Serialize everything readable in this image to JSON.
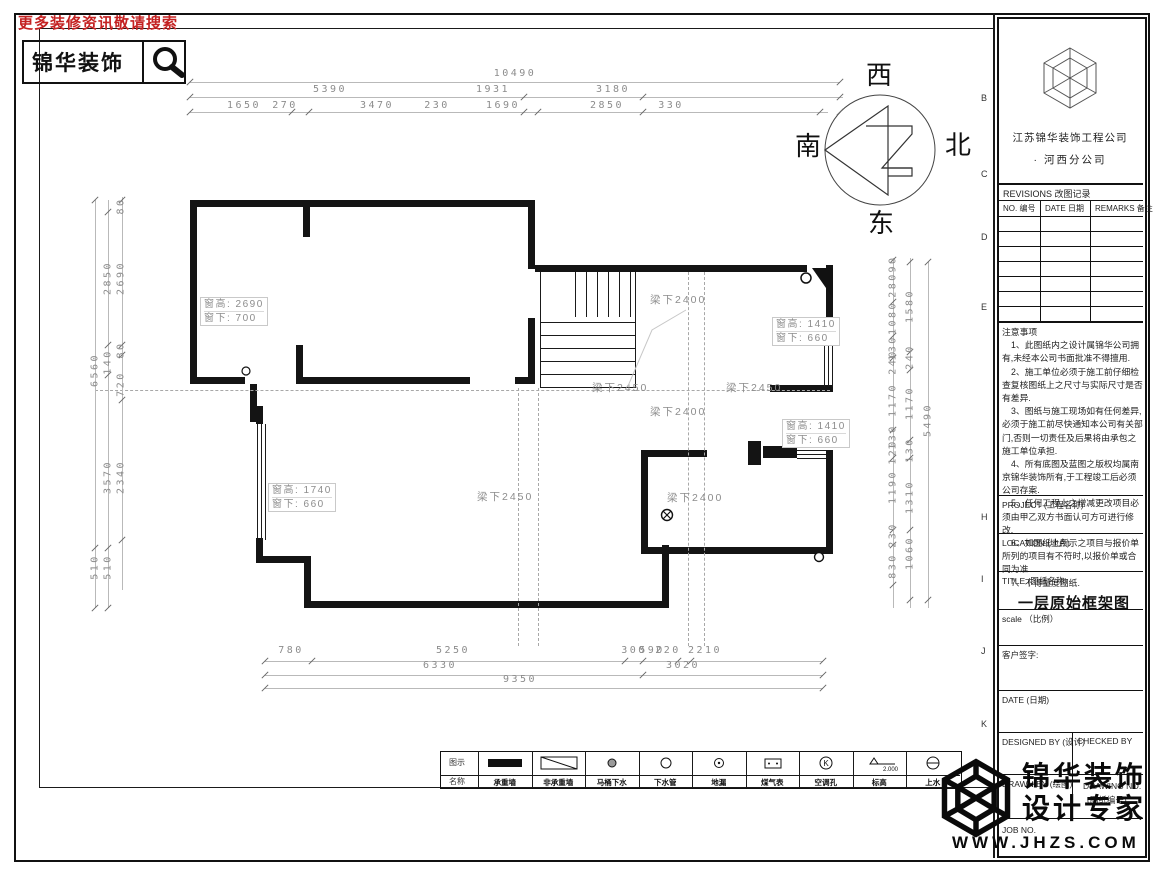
{
  "header": {
    "slogan": "更多装修资讯敬请搜索",
    "brand": "锦华装饰"
  },
  "compass": {
    "west": "西",
    "south": "南",
    "north": "北",
    "east": "东"
  },
  "zone_letters": [
    {
      "t": "B",
      "y": 93
    },
    {
      "t": "C",
      "y": 169
    },
    {
      "t": "D",
      "y": 232
    },
    {
      "t": "E",
      "y": 302
    },
    {
      "t": "H",
      "y": 512
    },
    {
      "t": "I",
      "y": 574
    },
    {
      "t": "J",
      "y": 646
    },
    {
      "t": "K",
      "y": 719
    }
  ],
  "plan": {
    "window_labels": [
      {
        "l1": "窗高: 2690",
        "l2": "窗下: 700",
        "x": 200,
        "y": 297
      },
      {
        "l1": "窗高: 1410",
        "l2": "窗下: 660",
        "x": 772,
        "y": 317
      },
      {
        "l1": "窗高: 1410",
        "l2": "窗下: 660",
        "x": 782,
        "y": 419
      },
      {
        "l1": "窗高: 1740",
        "l2": "窗下: 660",
        "x": 268,
        "y": 483
      }
    ],
    "beam_labels": [
      {
        "t": "梁下2400",
        "x": 650,
        "y": 292
      },
      {
        "t": "梁下2450",
        "x": 592,
        "y": 380
      },
      {
        "t": "梁下2450",
        "x": 726,
        "y": 380
      },
      {
        "t": "梁下2400",
        "x": 650,
        "y": 404
      },
      {
        "t": "梁下2450",
        "x": 477,
        "y": 489
      },
      {
        "t": "梁下2400",
        "x": 667,
        "y": 490
      }
    ]
  },
  "dims": {
    "top": [
      {
        "t": "10490",
        "x": 515,
        "y": 68
      },
      {
        "t": "5390",
        "x": 330,
        "y": 84
      },
      {
        "t": "1931",
        "x": 493,
        "y": 84
      },
      {
        "t": "3180",
        "x": 613,
        "y": 84
      },
      {
        "t": "1650",
        "x": 244,
        "y": 100
      },
      {
        "t": "270",
        "x": 285,
        "y": 100
      },
      {
        "t": "3470",
        "x": 377,
        "y": 100
      },
      {
        "t": "230",
        "x": 437,
        "y": 100
      },
      {
        "t": "1690",
        "x": 503,
        "y": 100
      },
      {
        "t": "2850",
        "x": 607,
        "y": 100
      },
      {
        "t": "330",
        "x": 671,
        "y": 100
      }
    ],
    "bottom": [
      {
        "t": "780",
        "x": 291,
        "y": 645
      },
      {
        "t": "5250",
        "x": 453,
        "y": 645
      },
      {
        "t": "300",
        "x": 634,
        "y": 645
      },
      {
        "t": "590",
        "x": 652,
        "y": 645
      },
      {
        "t": "220",
        "x": 668,
        "y": 645
      },
      {
        "t": "2210",
        "x": 705,
        "y": 645
      },
      {
        "t": "6330",
        "x": 440,
        "y": 660
      },
      {
        "t": "3020",
        "x": 683,
        "y": 660
      },
      {
        "t": "9350",
        "x": 520,
        "y": 674
      }
    ],
    "left": [
      {
        "t": "6560",
        "x": 95,
        "y": 370
      },
      {
        "t": "510",
        "x": 95,
        "y": 567
      },
      {
        "t": "2850",
        "x": 108,
        "y": 278
      },
      {
        "t": "140",
        "x": 108,
        "y": 362
      },
      {
        "t": "3570",
        "x": 108,
        "y": 477
      },
      {
        "t": "510",
        "x": 108,
        "y": 567
      },
      {
        "t": "80",
        "x": 121,
        "y": 206
      },
      {
        "t": "2690",
        "x": 121,
        "y": 278
      },
      {
        "t": "80",
        "x": 121,
        "y": 350
      },
      {
        "t": "720",
        "x": 121,
        "y": 384
      },
      {
        "t": "2340",
        "x": 121,
        "y": 477
      }
    ],
    "right": [
      {
        "t": "90",
        "x": 893,
        "y": 264
      },
      {
        "t": "280",
        "x": 893,
        "y": 285
      },
      {
        "t": "1080",
        "x": 893,
        "y": 318
      },
      {
        "t": "130",
        "x": 893,
        "y": 348
      },
      {
        "t": "240",
        "x": 893,
        "y": 362
      },
      {
        "t": "1170",
        "x": 893,
        "y": 400
      },
      {
        "t": "130",
        "x": 893,
        "y": 437
      },
      {
        "t": "120",
        "x": 893,
        "y": 452
      },
      {
        "t": "1190",
        "x": 893,
        "y": 487
      },
      {
        "t": "230",
        "x": 893,
        "y": 535
      },
      {
        "t": "830",
        "x": 893,
        "y": 566
      },
      {
        "t": "1580",
        "x": 910,
        "y": 306
      },
      {
        "t": "240",
        "x": 910,
        "y": 357
      },
      {
        "t": "1170",
        "x": 910,
        "y": 403
      },
      {
        "t": "130",
        "x": 910,
        "y": 450
      },
      {
        "t": "1310",
        "x": 910,
        "y": 497
      },
      {
        "t": "1060",
        "x": 910,
        "y": 553
      },
      {
        "t": "5490",
        "x": 928,
        "y": 420
      }
    ]
  },
  "title_block": {
    "company_line1": "江苏锦华装饰工程公司",
    "company_line2": "·  河西分公司",
    "revisions": {
      "header": "REVISIONS 改图记录",
      "columns": [
        "NO. 编号",
        "DATE 日期",
        "REMARKS 备注"
      ],
      "empty_rows": 7
    },
    "notes_title": "注意事项",
    "notes": [
      "1、此图纸内之设计属锦华公司拥有,未经本公司书面批准不得擅用.",
      "2、施工单位必须于施工前仔细检查复核图纸上之尺寸与实际尺寸是否有差异.",
      "3、图纸与施工现场如有任何差异,必须于施工前尽快通知本公司有关部门,否则一切责任及后果将由承包之施工单位承担.",
      "4、所有底图及蓝图之版权均属南京锦华装饰所有,于工程竣工后必须公司存案.",
      "5、任何工程上之增减更改项目必须由甲乙双方书面认可方可进行修改.",
      "6、如图纸上所示之项目与报价单所列的项目有不符时,以报价单或合同为准.",
      "7、不得量度图纸."
    ],
    "fields": {
      "project": "PROJECT (工程名称)",
      "location": "LOCATION (地点)",
      "title_label": "TITLE (图纸名称)",
      "title_value": "一层原始框架图",
      "scale": "scale （比例）",
      "client_sign": "客户签字:",
      "date": "DATE (日期)",
      "designed_by": "DESIGNED BY (设计)",
      "checked_by": "CHECKED BY",
      "drawn_by": "DRAWN BY (绘图)",
      "drawing_no_1": "DRAWING NO.",
      "drawing_no_2": "(图纸编号)",
      "job_no": "JOB NO."
    }
  },
  "legend": {
    "symbol_row_label": "图示",
    "name_row_label": "名称",
    "items": [
      {
        "symbol": "solid-wall",
        "name": "承重墙"
      },
      {
        "symbol": "diag-wall",
        "name": "非承重墙"
      },
      {
        "symbol": "filled-circle",
        "name": "马桶下水"
      },
      {
        "symbol": "circle",
        "name": "下水管"
      },
      {
        "symbol": "dot-circle",
        "name": "地漏"
      },
      {
        "symbol": "meter-box",
        "name": "煤气表"
      },
      {
        "symbol": "k-circle",
        "name": "空调孔"
      },
      {
        "symbol": "elevation",
        "name": "标高",
        "value": "2.000"
      },
      {
        "symbol": "line-circle",
        "name": "上水"
      }
    ]
  },
  "footer_logo": {
    "brand_line1": "锦华装饰",
    "brand_line2": "设计专家",
    "website": "WWW.JHZS.COM"
  }
}
